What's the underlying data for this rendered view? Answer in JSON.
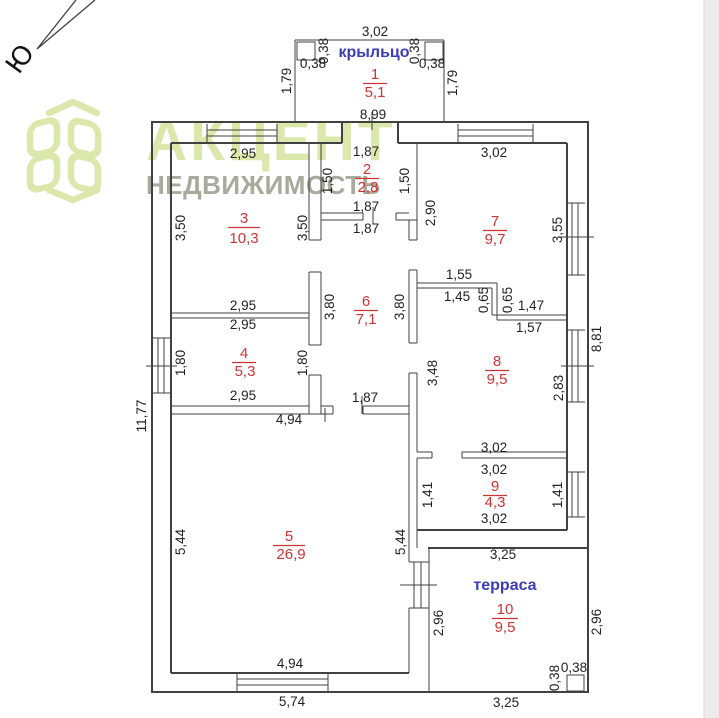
{
  "compass": {
    "label": "Ю"
  },
  "logo": {
    "title": "АКЦЕНТ",
    "subtitle": "НЕДВИЖИМОСТЬ"
  },
  "colors": {
    "walls": "#414141",
    "dimension_text": "#1f1f1f",
    "room_label_red": "#cc3434",
    "room_name_blue": "#3c3cb4",
    "logo_green": "#dce7ab",
    "logo_gray": "#a8aa9c",
    "right_strip": "#ececec"
  },
  "plan": {
    "names": {
      "porch": "крыльцо",
      "terrace": "терраса"
    },
    "rooms": [
      {
        "number": "1",
        "area": "5,1",
        "nx": 375,
        "ny": 79,
        "ax": 375,
        "ay": 97,
        "w": 24
      },
      {
        "number": "2",
        "area": "2,8",
        "nx": 367,
        "ny": 174,
        "ax": 368,
        "ay": 192,
        "w": 24
      },
      {
        "number": "3",
        "area": "10,3",
        "nx": 244,
        "ny": 223,
        "ax": 244,
        "ay": 243,
        "w": 32
      },
      {
        "number": "4",
        "area": "5,3",
        "nx": 244,
        "ny": 358,
        "ax": 245,
        "ay": 376,
        "w": 24
      },
      {
        "number": "5",
        "area": "26,9",
        "nx": 289,
        "ny": 541,
        "ax": 291,
        "ay": 559,
        "w": 32
      },
      {
        "number": "6",
        "area": "7,1",
        "nx": 366,
        "ny": 306,
        "ax": 366,
        "ay": 324,
        "w": 24
      },
      {
        "number": "7",
        "area": "9,7",
        "nx": 495,
        "ny": 226,
        "ax": 495,
        "ay": 244,
        "w": 24
      },
      {
        "number": "8",
        "area": "9,5",
        "nx": 497,
        "ny": 366,
        "ax": 497,
        "ay": 384,
        "w": 24
      },
      {
        "number": "9",
        "area": "4,3",
        "nx": 495,
        "ny": 491,
        "ax": 495,
        "ay": 507,
        "w": 24
      },
      {
        "number": "10",
        "area": "9,5",
        "nx": 505,
        "ny": 614,
        "ax": 505,
        "ay": 632,
        "w": 26
      }
    ],
    "dimensions": [
      {
        "t": "3,02",
        "x": 375,
        "y": 36,
        "r": 0
      },
      {
        "t": "0,38",
        "x": 313,
        "y": 68,
        "r": 0
      },
      {
        "t": "0,38",
        "x": 432,
        "y": 68,
        "r": 0
      },
      {
        "t": "8,99",
        "x": 373,
        "y": 119,
        "r": 0
      },
      {
        "t": "2,95",
        "x": 243,
        "y": 158,
        "r": 0
      },
      {
        "t": "1,87",
        "x": 366,
        "y": 156,
        "r": 0
      },
      {
        "t": "3,02",
        "x": 494,
        "y": 157,
        "r": 0
      },
      {
        "t": "1,87",
        "x": 366,
        "y": 211,
        "r": 0
      },
      {
        "t": "1,87",
        "x": 366,
        "y": 233,
        "r": 0
      },
      {
        "t": "1,55",
        "x": 459,
        "y": 279,
        "r": 0
      },
      {
        "t": "1,45",
        "x": 457,
        "y": 301,
        "r": 0
      },
      {
        "t": "1,47",
        "x": 531,
        "y": 310,
        "r": 0
      },
      {
        "t": "1,57",
        "x": 529,
        "y": 332,
        "r": 0
      },
      {
        "t": "2,95",
        "x": 243,
        "y": 310,
        "r": 0
      },
      {
        "t": "2,95",
        "x": 243,
        "y": 329,
        "r": 0
      },
      {
        "t": "2,95",
        "x": 243,
        "y": 400,
        "r": 0
      },
      {
        "t": "1,87",
        "x": 365,
        "y": 402,
        "r": 0
      },
      {
        "t": "4,94",
        "x": 289,
        "y": 424,
        "r": 0
      },
      {
        "t": "3,02",
        "x": 494,
        "y": 452,
        "r": 0
      },
      {
        "t": "3,02",
        "x": 494,
        "y": 474,
        "r": 0
      },
      {
        "t": "3,02",
        "x": 494,
        "y": 523,
        "r": 0
      },
      {
        "t": "3,25",
        "x": 503,
        "y": 559,
        "r": 0
      },
      {
        "t": "0,38",
        "x": 574,
        "y": 672,
        "r": 0
      },
      {
        "t": "4,94",
        "x": 290,
        "y": 668,
        "r": 0
      },
      {
        "t": "5,74",
        "x": 292,
        "y": 706,
        "r": 0
      },
      {
        "t": "3,25",
        "x": 506,
        "y": 707,
        "r": 0
      },
      {
        "t": "1,79",
        "x": 287,
        "y": 81,
        "r": -90
      },
      {
        "t": "0,38",
        "x": 324,
        "y": 51,
        "r": -90
      },
      {
        "t": "0,38",
        "x": 415,
        "y": 51,
        "r": -90
      },
      {
        "t": "1,79",
        "x": 453,
        "y": 83,
        "r": -90
      },
      {
        "t": "1,50",
        "x": 328,
        "y": 181,
        "r": -90
      },
      {
        "t": "1,50",
        "x": 405,
        "y": 181,
        "r": -90
      },
      {
        "t": "3,50",
        "x": 181,
        "y": 228,
        "r": -90
      },
      {
        "t": "3,50",
        "x": 303,
        "y": 228,
        "r": -90
      },
      {
        "t": "2,90",
        "x": 431,
        "y": 213,
        "r": -90
      },
      {
        "t": "3,55",
        "x": 558,
        "y": 230,
        "r": -90
      },
      {
        "t": "0,65",
        "x": 484,
        "y": 300,
        "r": -90
      },
      {
        "t": "0,65",
        "x": 508,
        "y": 300,
        "r": -90
      },
      {
        "t": "3,80",
        "x": 330,
        "y": 307,
        "r": -90
      },
      {
        "t": "3,80",
        "x": 400,
        "y": 307,
        "r": -90
      },
      {
        "t": "1,80",
        "x": 181,
        "y": 363,
        "r": -90
      },
      {
        "t": "1,80",
        "x": 303,
        "y": 363,
        "r": -90
      },
      {
        "t": "3,48",
        "x": 433,
        "y": 373,
        "r": -90
      },
      {
        "t": "2,83",
        "x": 559,
        "y": 388,
        "r": -90
      },
      {
        "t": "8,81",
        "x": 597,
        "y": 339,
        "r": -90
      },
      {
        "t": "11,77",
        "x": 142,
        "y": 416,
        "r": -90
      },
      {
        "t": "5,44",
        "x": 181,
        "y": 542,
        "r": -90
      },
      {
        "t": "5,44",
        "x": 401,
        "y": 542,
        "r": -90
      },
      {
        "t": "1,41",
        "x": 428,
        "y": 495,
        "r": -90
      },
      {
        "t": "1,41",
        "x": 558,
        "y": 495,
        "r": -90
      },
      {
        "t": "2,96",
        "x": 439,
        "y": 623,
        "r": -90
      },
      {
        "t": "2,96",
        "x": 597,
        "y": 622,
        "r": -90
      },
      {
        "t": "0,38",
        "x": 555,
        "y": 678,
        "r": -90
      }
    ]
  }
}
